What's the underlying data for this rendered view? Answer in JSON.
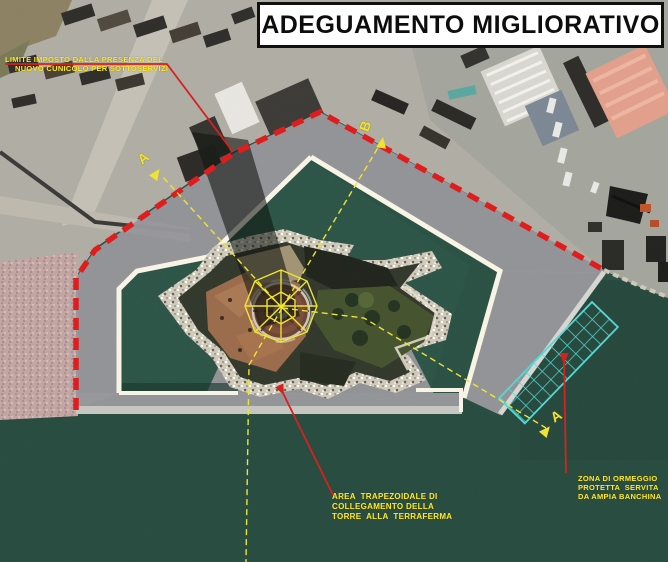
{
  "title_box": {
    "text": "ADEGUAMENTO MIGLIORATIVO"
  },
  "labels": {
    "limite": {
      "line1": "LIMITE IMPOSTO DALLA PRESENZA DEL",
      "line2": "NUOVO CUNICOLO PER SOTTOSERVIZI"
    },
    "area": {
      "line1": "AREA  TRAPEZOIDALE DI",
      "line2": "COLLEGAMENTO DELLA",
      "line3": "TORRE  ALLA  TERRAFERMA"
    },
    "zona": {
      "line1": "ZONA DI ORMEGGIO",
      "line2": "PROTETTA  SERVITA",
      "line3": "DA AMPIA BANCHINA"
    }
  },
  "section_markers": {
    "a_top_left": "A",
    "b_top": "B",
    "a_bottom_right": "A"
  },
  "colors": {
    "limit_line": "#e01d1d",
    "leader_line": "#d82020",
    "axis_line": "#f0e431",
    "mooring_grid": "#55d8d4",
    "new_works_fill": "#97979b",
    "basin_edge": "#f8f4e6",
    "title_text": "#0d0d0d",
    "label_text": "#ffe82a"
  }
}
